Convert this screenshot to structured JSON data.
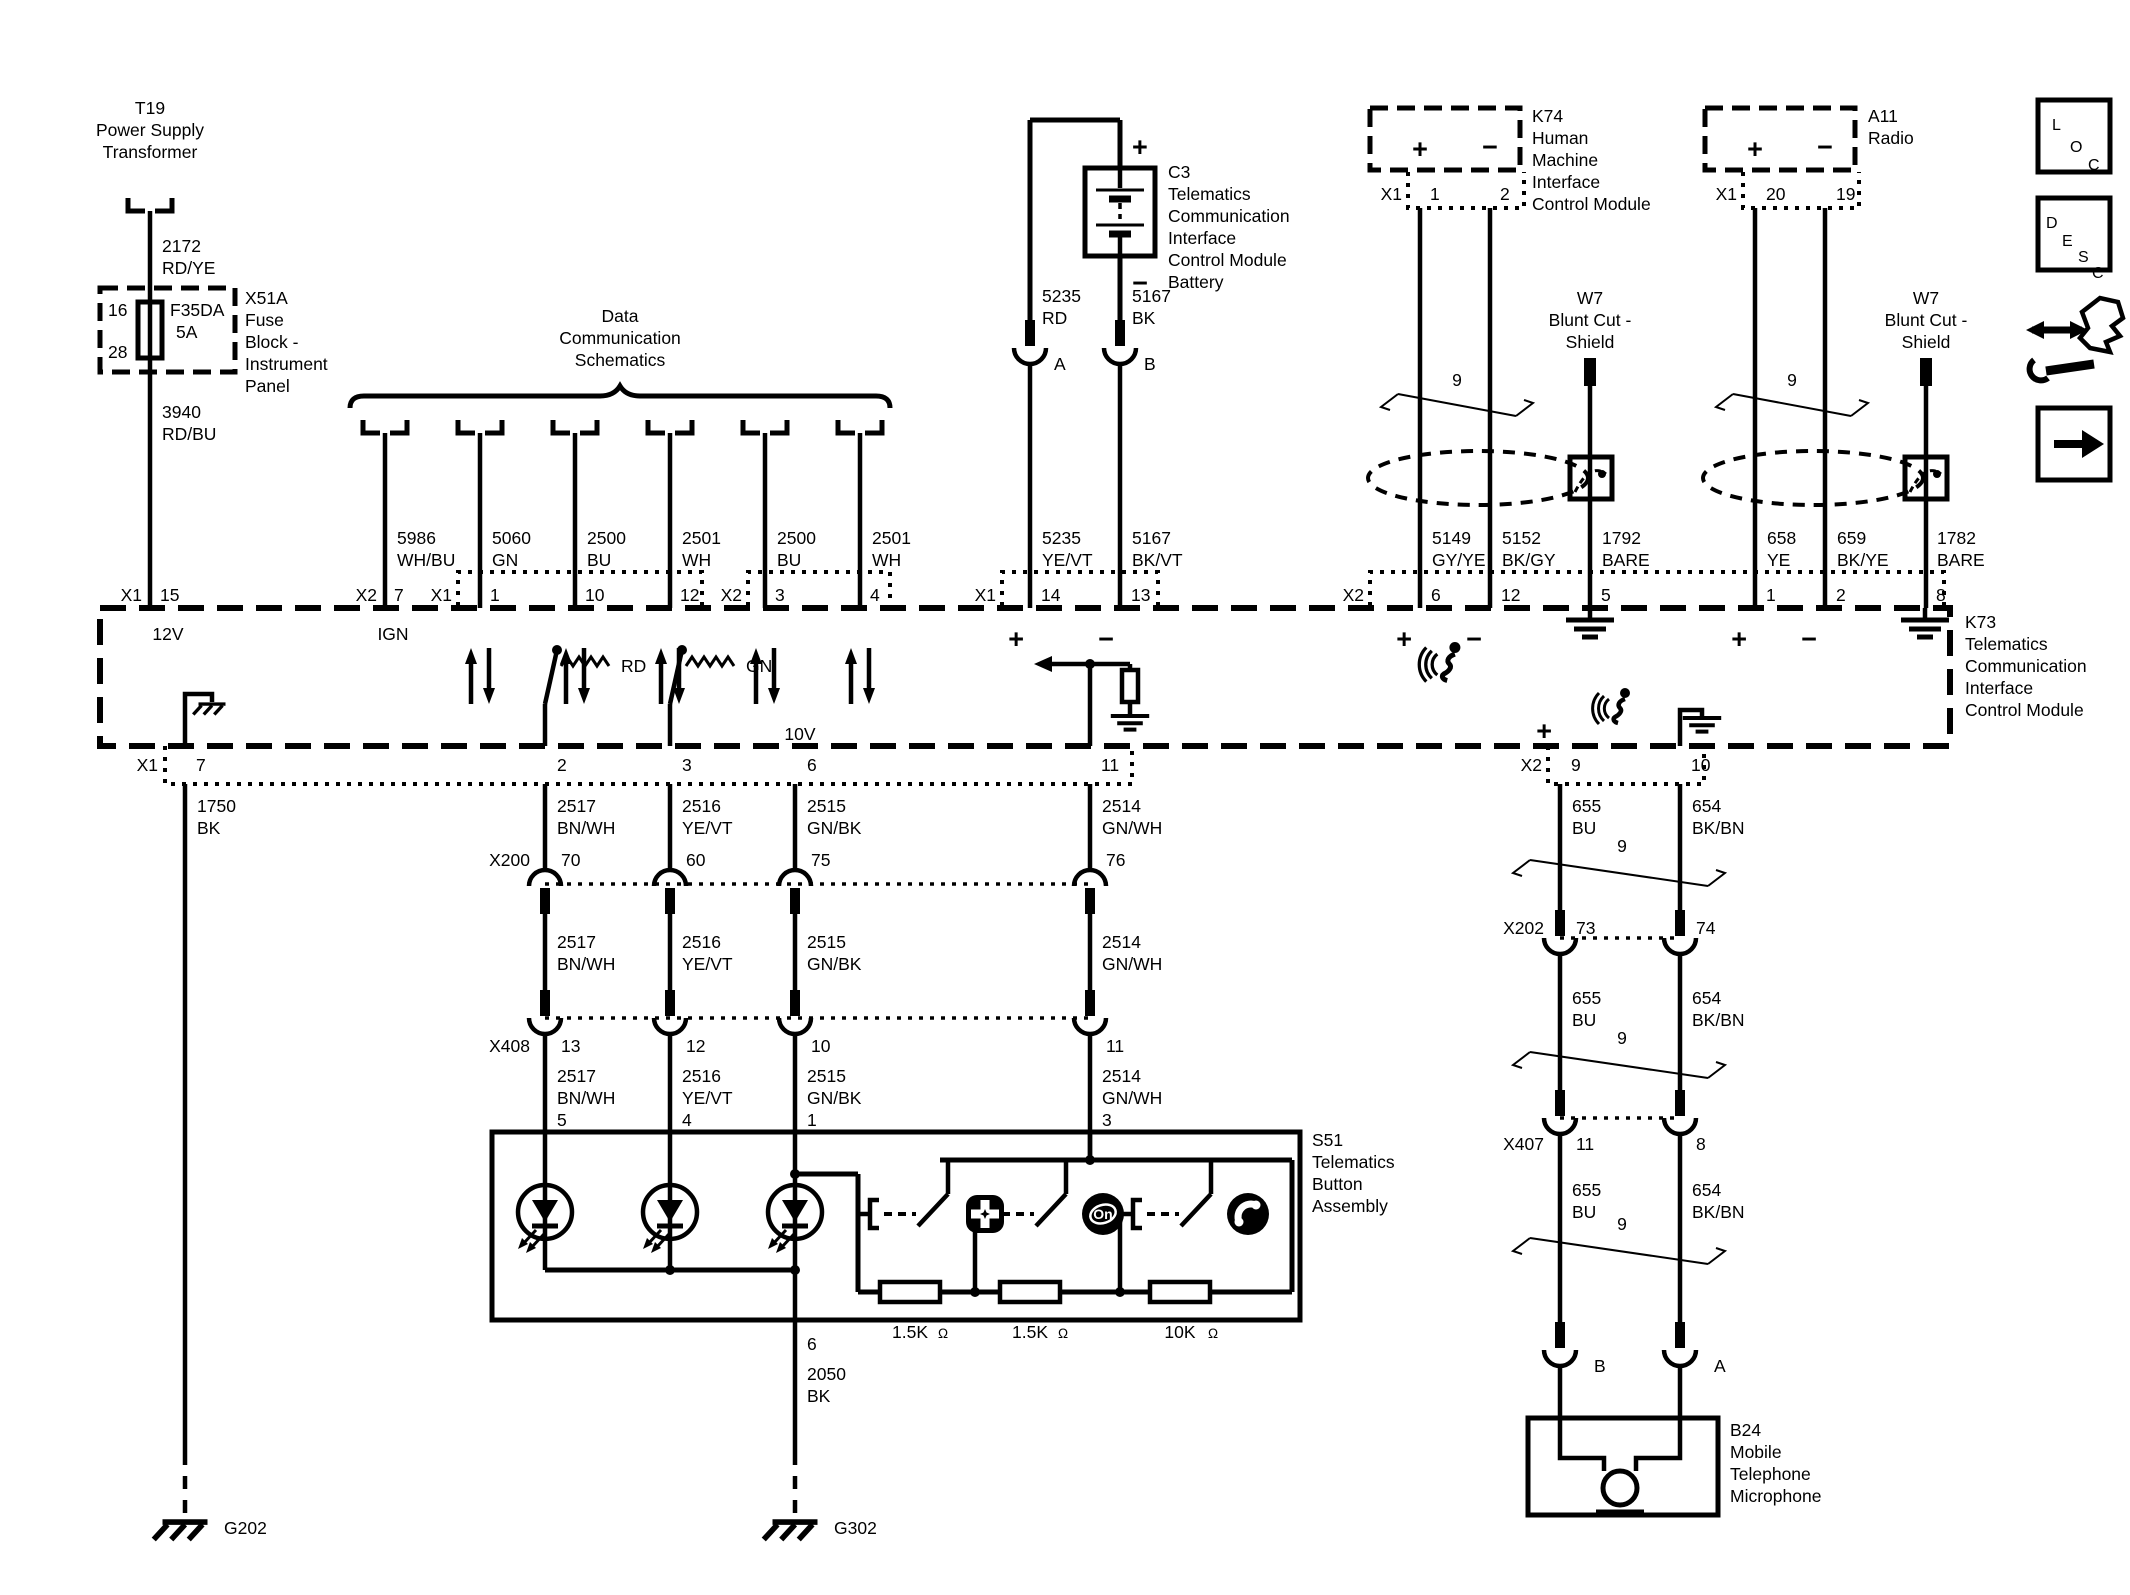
{
  "colors": {
    "ink": "#000000",
    "paper": "#ffffff"
  },
  "symbols": {
    "plus": "+",
    "minus": "−",
    "ohm": "Ω"
  },
  "legend": {
    "loc": [
      "L",
      "O",
      "C"
    ],
    "desc": [
      "D",
      "E",
      "S",
      "C"
    ]
  },
  "power": {
    "t19": {
      "ref": "T19",
      "name1": "Power Supply",
      "name2": "Transformer"
    },
    "wire2172": {
      "num": "2172",
      "color": "RD/YE"
    },
    "fuseblock": {
      "ref": "X51A",
      "desc": [
        "Fuse",
        "Block -",
        "Instrument",
        "Panel"
      ],
      "pin_in": "16",
      "pin_out": "28",
      "fuse": "F35DA",
      "rating": "5A"
    },
    "wire3940": {
      "num": "3940",
      "color": "RD/BU"
    },
    "conn": "X1",
    "pin": "15",
    "signal": "12V"
  },
  "datacomm": {
    "title": [
      "Data",
      "Communication",
      "Schematics"
    ],
    "drops": [
      {
        "conn": "X2",
        "pin": "7",
        "signal": "IGN",
        "wire": "5986",
        "color": "WH/BU"
      },
      {
        "conn": "X1",
        "pin": "1",
        "wire": "5060",
        "color": "GN"
      },
      {
        "pin": "10",
        "wire": "2500",
        "color": "BU"
      },
      {
        "pin": "12",
        "wire": "2501",
        "color": "WH"
      },
      {
        "conn": "X2",
        "pin": "3",
        "wire": "2500",
        "color": "BU"
      },
      {
        "pin": "4",
        "wire": "2501",
        "color": "WH"
      }
    ]
  },
  "battery": {
    "ref": "C3",
    "desc": [
      "Telematics",
      "Communication",
      "Interface",
      "Control Module",
      "Battery"
    ],
    "wireA": {
      "num": "5235",
      "color": "RD",
      "color2": "YE/VT",
      "term": "A"
    },
    "wireB": {
      "num": "5167",
      "color": "BK",
      "color2": "BK/VT",
      "term": "B"
    },
    "conn": "X1",
    "pinA": "14",
    "pinB": "13"
  },
  "k74": {
    "ref": "K74",
    "desc": [
      "Human",
      "Machine",
      "Interface",
      "Control Module"
    ],
    "conn": "X1",
    "pin1": "1",
    "pin2": "2",
    "twist": "9",
    "w7": {
      "ref": "W7",
      "name1": "Blunt Cut -",
      "name2": "Shield"
    },
    "wires": [
      {
        "num": "5149",
        "color": "GY/YE"
      },
      {
        "num": "5152",
        "color": "BK/GY"
      },
      {
        "num": "1792",
        "color": "BARE"
      }
    ],
    "conn2": "X2",
    "pins": [
      "6",
      "12",
      "5"
    ]
  },
  "a11": {
    "ref": "A11",
    "name": "Radio",
    "conn": "X1",
    "pin1": "20",
    "pin2": "19",
    "twist": "9",
    "w7": {
      "ref": "W7",
      "name1": "Blunt Cut -",
      "name2": "Shield"
    },
    "wires": [
      {
        "num": "658",
        "color": "YE"
      },
      {
        "num": "659",
        "color": "BK/YE"
      },
      {
        "num": "1782",
        "color": "BARE"
      }
    ],
    "pins": [
      "1",
      "2",
      "8"
    ]
  },
  "k73": {
    "ref": "K73",
    "desc": [
      "Telematics",
      "Communication",
      "Interface",
      "Control Module"
    ],
    "gnd": {
      "conn": "X1",
      "pin": "7"
    },
    "drivers": [
      {
        "label": "RD"
      },
      {
        "label": "GN"
      }
    ],
    "supply": "10V",
    "pins": [
      "2",
      "3",
      "6",
      "11"
    ],
    "mic": {
      "conn": "X2",
      "pin1": "9",
      "pin2": "10"
    }
  },
  "leftground": {
    "wire": {
      "num": "1750",
      "color": "BK"
    },
    "label": "G202"
  },
  "buttons": {
    "wires": [
      {
        "num": "2517",
        "color": "BN/WH"
      },
      {
        "num": "2516",
        "color": "YE/VT"
      },
      {
        "num": "2515",
        "color": "GN/BK"
      },
      {
        "num": "2514",
        "color": "GN/WH"
      }
    ],
    "x200": {
      "ref": "X200",
      "pins": [
        "70",
        "60",
        "75",
        "76"
      ]
    },
    "x408": {
      "ref": "X408",
      "pins": [
        "13",
        "12",
        "10",
        "11"
      ]
    },
    "s51": {
      "ref": "S51",
      "desc": [
        "Telematics",
        "Button",
        "Assembly"
      ],
      "pins_in": [
        "5",
        "4",
        "1",
        "3"
      ],
      "pin_out": "6",
      "onstar": "On",
      "resistors": [
        "1.5K",
        "1.5K",
        "10K"
      ]
    },
    "wire2050": {
      "num": "2050",
      "color": "BK"
    },
    "glabel": "G302"
  },
  "micline": {
    "wires": [
      {
        "num": "655",
        "color": "BU"
      },
      {
        "num": "654",
        "color": "BK/BN"
      }
    ],
    "twist": "9",
    "x202": {
      "ref": "X202",
      "pins": [
        "73",
        "74"
      ]
    },
    "x407": {
      "ref": "X407",
      "pins": [
        "11",
        "8"
      ]
    },
    "terms": [
      "B",
      "A"
    ],
    "b24": {
      "ref": "B24",
      "desc": [
        "Mobile",
        "Telephone",
        "Microphone"
      ]
    }
  }
}
